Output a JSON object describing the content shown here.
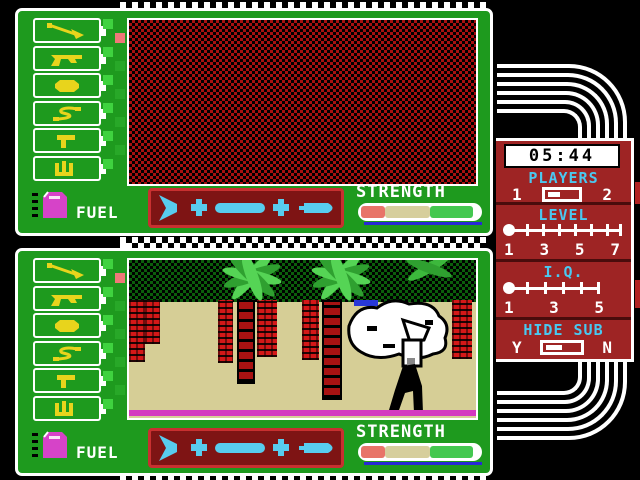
{
  "panels": {
    "fuel_label": "FUEL",
    "strength_label": "STRENGTH",
    "tools": [
      "pickaxe",
      "pistol",
      "coconut-bomb",
      "rope",
      "shovel",
      "saw"
    ],
    "sub_parts": [
      "tail-fin",
      "connector",
      "hull-section",
      "connector",
      "nose-cone"
    ],
    "strength_segments": [
      "#E87468",
      "#D6CE9C",
      "#44C850"
    ]
  },
  "console": {
    "timer": "05:44",
    "players": {
      "label": "PLAYERS",
      "option_left": "1",
      "option_right": "2",
      "selected": "1"
    },
    "level": {
      "label": "LEVEL",
      "ticks": [
        "1",
        "3",
        "5",
        "7"
      ],
      "selected": "1"
    },
    "iq": {
      "label": "I.Q.",
      "ticks": [
        "1",
        "3",
        "5"
      ],
      "selected": "1"
    },
    "hide_sub": {
      "label": "HIDE SUB",
      "option_left": "Y",
      "option_right": "N",
      "selected": "Y"
    }
  },
  "colors": {
    "panel_green": "#1E9A1E",
    "console_red": "#9E2424",
    "label_cyan": "#4AC8F0",
    "sand": "#D6CE96",
    "ground_magenta": "#D438C0",
    "sub_cyan": "#58CCEE",
    "icon_yellow": "#E8D41C"
  }
}
